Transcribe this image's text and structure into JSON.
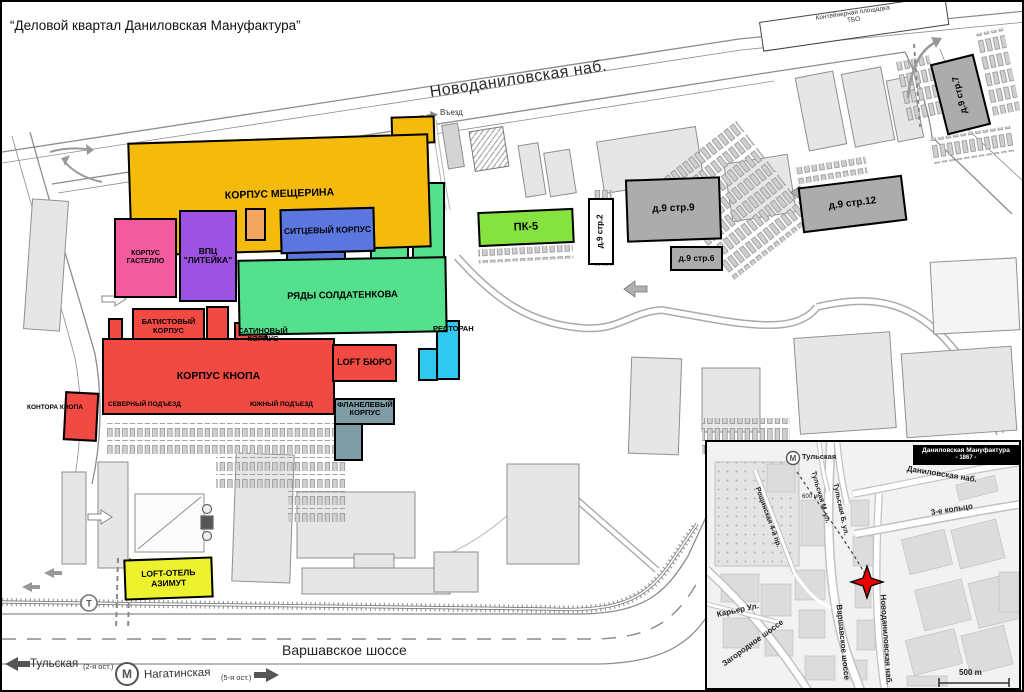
{
  "title": "“Деловой квартал Даниловская Мануфактура”",
  "main_map": {
    "streets": {
      "embankment": "Новоданиловская наб.",
      "highway": "Варшавское шоссе"
    },
    "markers": {
      "entry": "Въезд",
      "exit": "Выезд",
      "waste_line1": "Контейнерная площадка",
      "waste_line2": "ТБО"
    },
    "transit": {
      "metro_letter": "М",
      "tram_letter": "Т",
      "stop_left": "Тульская",
      "stop_left_note": "(2-я ост.)",
      "stop_right": "Нагатинская",
      "stop_right_note": "(5-я ост.)"
    },
    "buildings": {
      "meshcherina": {
        "label": "КОРПУС МЕЩЕРИНА",
        "color": "#F5BB0C"
      },
      "gastello": {
        "label": "КОРПУС ГАСТЕЛЛО",
        "color": "#F25C9E"
      },
      "liteyka": {
        "label": "ВПЦ \"ЛИТЕЙКА\"",
        "color": "#9C52E2"
      },
      "annex_orange": {
        "color": "#F2A55F"
      },
      "sitsevy": {
        "label": "СИТЦЕВЫЙ КОРПУС",
        "color": "#5B76DE"
      },
      "soldatenkova": {
        "label": "РЯДЫ СОЛДАТЕНКОВА",
        "color": "#55E08E"
      },
      "batistovy": {
        "label": "БАТИСТОВЫЙ КОРПУС",
        "color": "#F04A42"
      },
      "satinovy": {
        "label": "САТИНОВЫЙ КОРПУС",
        "color": "#F04A42"
      },
      "knopa": {
        "label": "КОРПУС КНОПА",
        "color": "#F04A42",
        "north": "СЕВЕРНЫЙ ПОДЪЕЗД",
        "south": "ЮЖНЫЙ ПОДЪЕЗД"
      },
      "kontora": {
        "label": "КОНТОРА КНОПА",
        "color": "#F04A42"
      },
      "loft_buro": {
        "label": "LOFT БЮРО",
        "color": "#F04A42"
      },
      "flanelevy": {
        "label": "ФЛАНЕЛЕВЫЙ КОРПУС",
        "color": "#7E9DA6"
      },
      "restoran": {
        "label": "РЕСТОРАН",
        "color": "#2FC9F0"
      },
      "pk5": {
        "label": "ПК-5",
        "color": "#86E23E"
      },
      "azimut": {
        "label": "LOFT-ОТЕЛЬ АЗИМУТ",
        "color": "#EDF22F"
      },
      "d9s2": {
        "label": "д.9 стр.2",
        "color": "#FFFFFF"
      },
      "d9s9": {
        "label": "д.9 стр.9",
        "color": "#ACACAC"
      },
      "d9s6": {
        "label": "д.9 стр.6",
        "color": "#ACACAC"
      },
      "d9s12": {
        "label": "д.9 стр.12",
        "color": "#ACACAC"
      },
      "d9s7": {
        "label": "д.9 стр.7",
        "color": "#ACACAC"
      }
    }
  },
  "inset": {
    "title_line1": "Даниловская Мануфактура",
    "title_line2": "- 1867 -",
    "metro_letter": "М",
    "metro_station": "Тульская",
    "distance_label": "600 м",
    "scale_label": "500 m",
    "marker_color": "#E80000",
    "streets": {
      "danilovskaya": "Даниловская наб.",
      "ring": "3-е кольцо",
      "tulskaya_m": "Тульская М. ул.",
      "tulskaya_b": "Тульская Б. ул.",
      "roshchinskaya": "Рощинская 4-й пр.",
      "karier": "Карьер Ул.",
      "zagorodnoe": "Загородное шоссе",
      "varshavskoe": "Варшавское шоссе",
      "novodanilovskaya": "Новоданиловская наб."
    }
  }
}
